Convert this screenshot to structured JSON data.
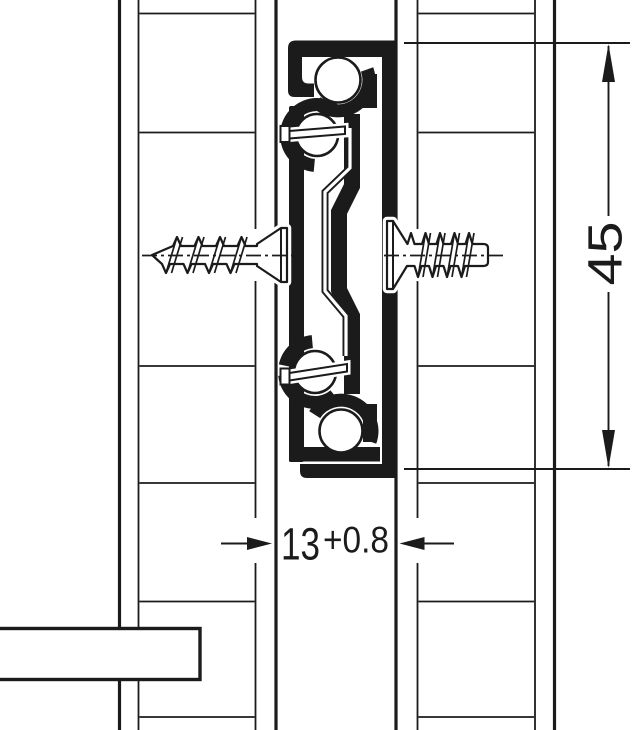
{
  "drawing": {
    "type": "technical cross-section of ball-bearing drawer runner mounted between two panels",
    "colors": {
      "ink": "#1b1b1b",
      "paper": "#ffffff"
    },
    "dimensions": {
      "height": {
        "value": "45"
      },
      "width": {
        "value": "13",
        "tolerance": "+0.8"
      }
    }
  }
}
